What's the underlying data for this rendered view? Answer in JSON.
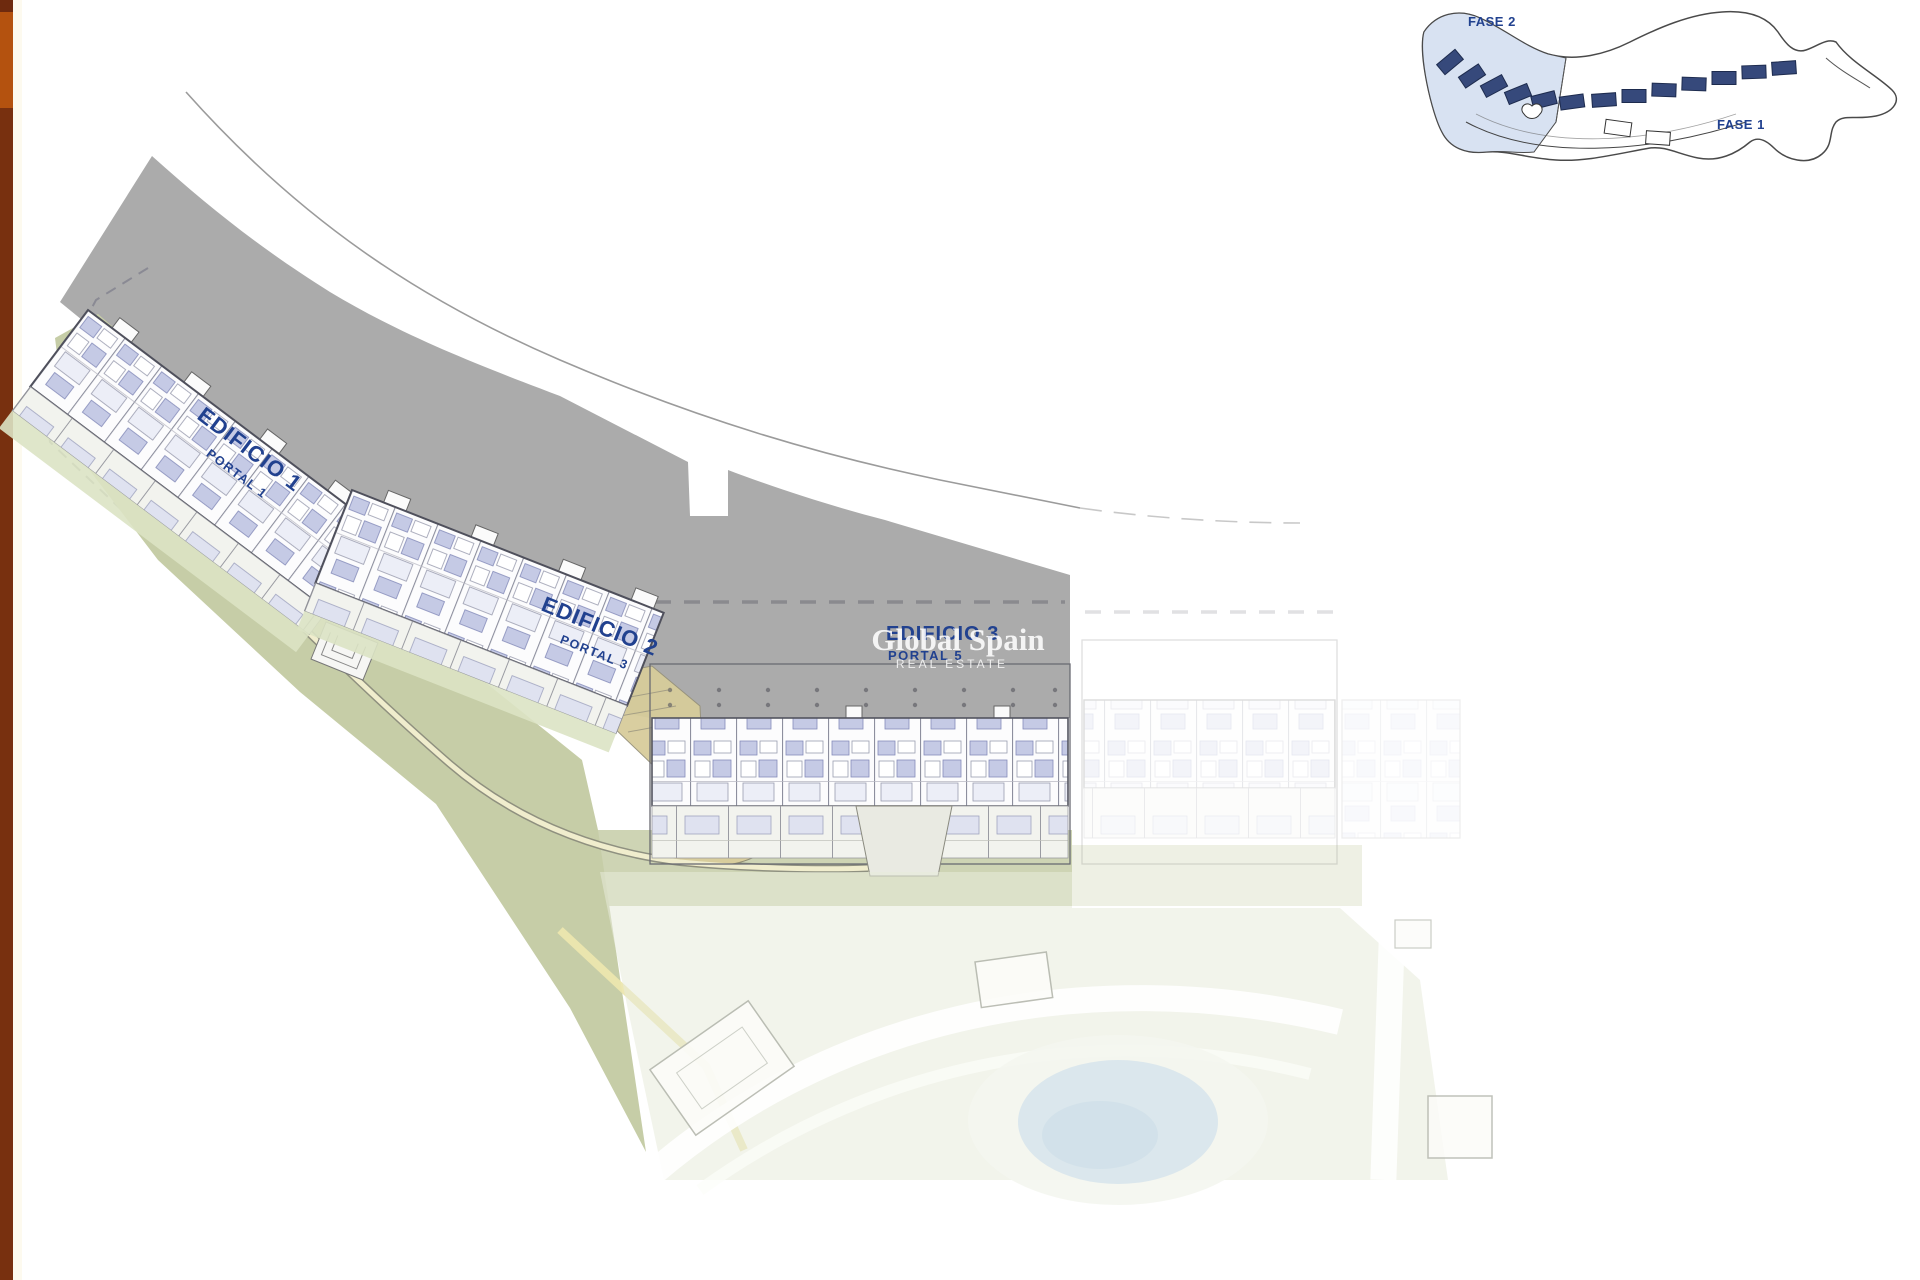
{
  "window": {
    "background": "#ffffff"
  },
  "accent_bar": {
    "top_color": "#6e2a0e",
    "orange_color": "#b4520f",
    "bottom_color": "#78300f"
  },
  "overview_map": {
    "phase2_label": "FASE 2",
    "phase1_label": "FASE 1",
    "highlight_color": "#d8e2f2",
    "block_color": "#36497b"
  },
  "site_plan": {
    "label_color": "#21418f",
    "ground_color": "#ababab",
    "landscape_color": "#c6cda7",
    "buildings": [
      {
        "name": "EDIFICIO 1",
        "portal": "PORTAL 1"
      },
      {
        "name": "EDIFICIO 2",
        "portal": "PORTAL 3"
      },
      {
        "name": "EDIFICIO 3",
        "portal": "PORTAL 5"
      }
    ]
  },
  "watermark": {
    "title": "Global Spain",
    "subtitle": "REAL ESTATE"
  }
}
